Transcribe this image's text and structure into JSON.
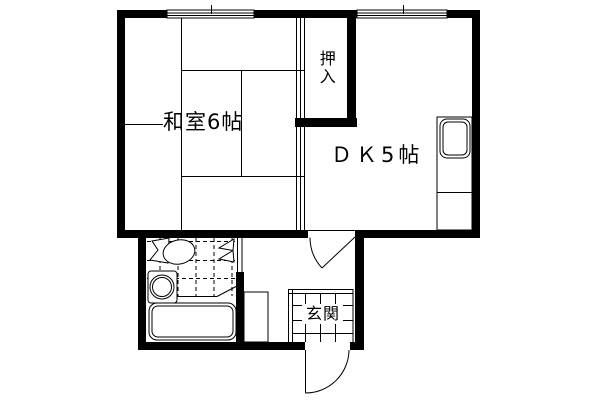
{
  "plan": {
    "type": "floor-plan",
    "background_color": "#ffffff",
    "line_color": "#000000",
    "rooms": [
      {
        "id": "washitsu",
        "label": "和室6帖"
      },
      {
        "id": "dk",
        "label": "ＤＫ5帖"
      },
      {
        "id": "oshiire",
        "label": "押入"
      },
      {
        "id": "genkan",
        "label": "玄関"
      }
    ],
    "fixtures": [
      "toilet",
      "wash-basin",
      "bathtub",
      "kitchen-sink",
      "shoe-cabinet"
    ],
    "openings": [
      "top-window-left",
      "top-window-right",
      "dk-hall-door",
      "front-door",
      "bathroom-folding-door",
      "fusuma-sliding-doors"
    ]
  }
}
